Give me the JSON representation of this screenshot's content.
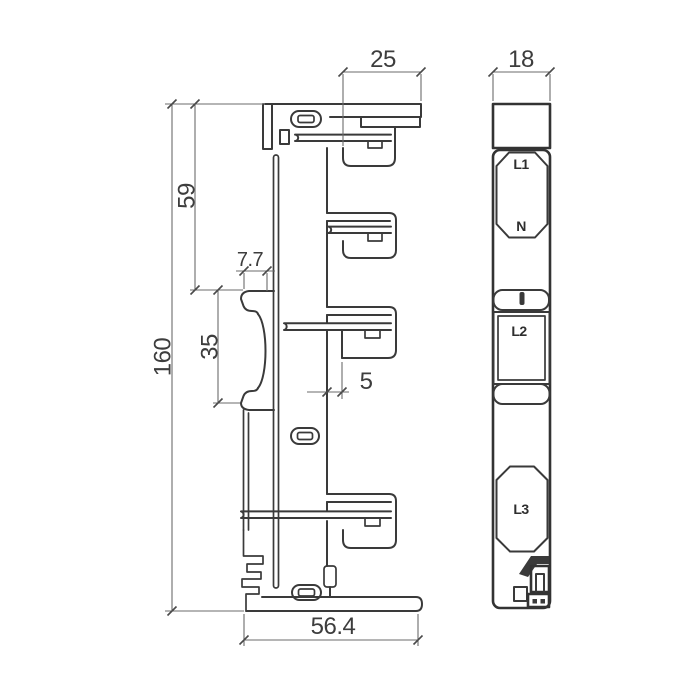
{
  "drawing": {
    "type": "two-view engineering drawing of DIN-rail busbar adapter",
    "views": {
      "front": "profile view with rail clip and terminal blades",
      "side": "face view with terminal windows"
    }
  },
  "dimensions": {
    "top_overhang": "25",
    "side_width": "18",
    "upper_height": "59",
    "clip_depth": "7.7",
    "overall_height": "160",
    "rail_opening": "35",
    "rib_width": "5",
    "base_width": "56.4"
  },
  "terminals": {
    "t1": "L1",
    "t2": "N",
    "t3": "L2",
    "t4": "L3"
  },
  "colors": {
    "object_line": "#3a3a3a",
    "dimension_line": "#6b6b6b",
    "text": "#3d3d3d",
    "background": "#ffffff"
  }
}
